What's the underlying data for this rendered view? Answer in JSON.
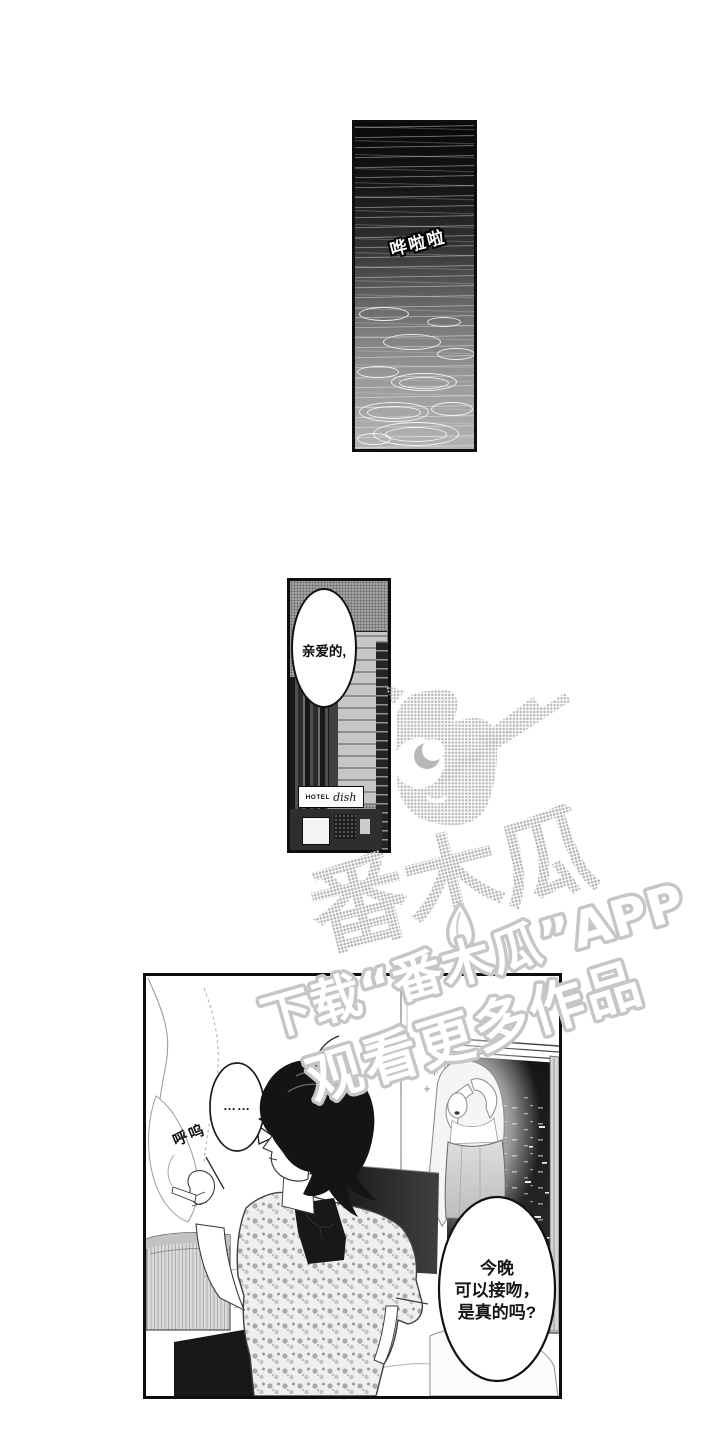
{
  "page": {
    "kind": "manga-page",
    "background": "#ffffff"
  },
  "panels": {
    "rain": {
      "sfx": "哗啦啦"
    },
    "hotel": {
      "bubble_text": "亲爱的,",
      "sign_hotel": "HOTEL",
      "sign_name": "dish"
    },
    "bedroom": {
      "bubble_ellipsis": "……",
      "sigh": "呼呜",
      "kiss_bubble": {
        "line1": "今晚",
        "line2": "可以接吻，",
        "line3": "是真的吗?"
      }
    }
  },
  "watermark": {
    "logo_text": "番木瓜",
    "download_line": "下载“番木瓜”APP",
    "watch_line": "观看更多作品",
    "mascot_icon": "papaya-mascot",
    "color": "#c3c3c3"
  },
  "colors": {
    "ink": "#111111",
    "paper": "#ffffff",
    "watermark_gray": "#c3c3c3"
  }
}
